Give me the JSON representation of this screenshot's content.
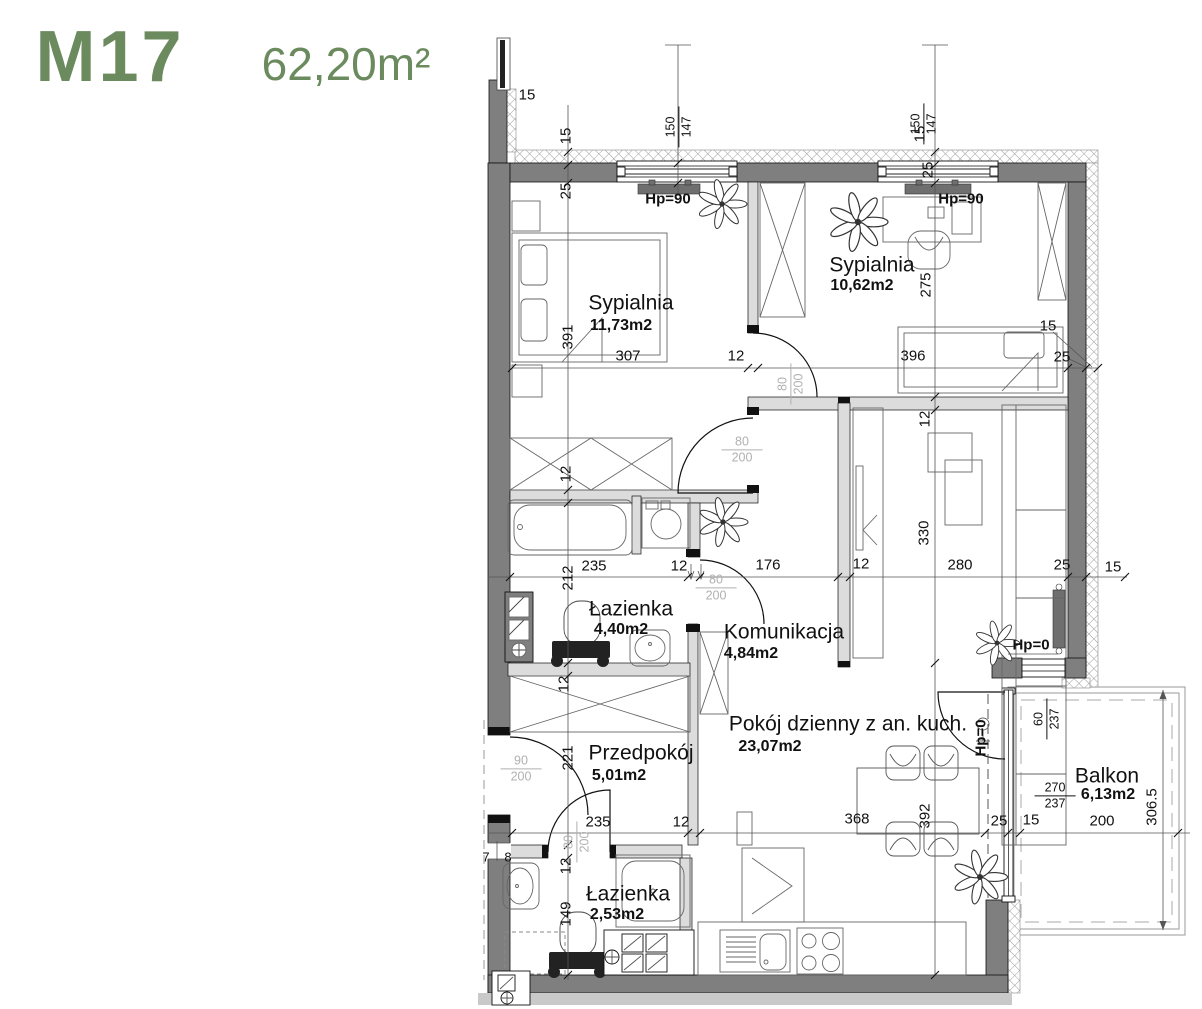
{
  "title": {
    "unit": "M17",
    "area": "62,20m²"
  },
  "rooms": [
    {
      "name": "Sypialnia",
      "area": "11,73m2"
    },
    {
      "name": "Sypialnia",
      "area": "10,62m2"
    },
    {
      "name": "Łazienka",
      "area": "4,40m2"
    },
    {
      "name": "Komunikacja",
      "area": "4,84m2"
    },
    {
      "name": "Przedpokój",
      "area": "5,01m2"
    },
    {
      "name": "Pokój dzienny z an. kuch.",
      "area": "23,07m2"
    },
    {
      "name": "Łazienka",
      "area": "2,53m2"
    },
    {
      "name": "Balkon",
      "area": "6,13m2"
    }
  ],
  "labels": {
    "hp90": "Hp=90",
    "hp0": "Hp=0"
  },
  "fractions": {
    "window_main": {
      "top": "150",
      "bottom": "147"
    },
    "door_80": {
      "top": "80",
      "bottom": "200"
    },
    "door_entry": {
      "top": "90",
      "bottom": "200"
    },
    "balcony_window": {
      "top": "60",
      "bottom": "237"
    },
    "balcony_door": {
      "top": "270",
      "bottom": "237"
    }
  },
  "dims": {
    "left_chain": [
      "15",
      "25",
      "391",
      "12",
      "212",
      "12",
      "221",
      "12",
      "149"
    ],
    "mid_chain": [
      "15",
      "25",
      "275",
      "12",
      "330",
      "392"
    ],
    "row_bedrooms": [
      "307",
      "12",
      "396"
    ],
    "corner_right": [
      "15",
      "25"
    ],
    "row_middle": [
      "235",
      "12",
      "176",
      "12",
      "280",
      "25",
      "15"
    ],
    "row_bottom": [
      "235",
      "12",
      "368",
      "25",
      "15",
      "200"
    ],
    "balcony_depth": "306.5",
    "top_left": "15",
    "entry_layers": [
      "7",
      "8"
    ]
  },
  "colors": {
    "accent": "#6b8a5e",
    "exterior_wall": "#7f7f7f",
    "interior_wall": "#dcdcdc",
    "dimension_text": "#111111",
    "door_label": "#b0b0b0"
  }
}
